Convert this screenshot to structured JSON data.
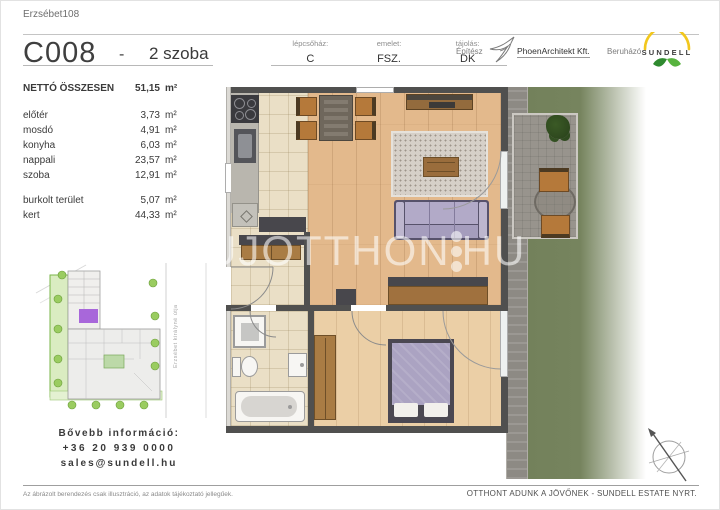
{
  "header": {
    "project": "Erzsébet108",
    "unit_code": "C008",
    "separator": "-",
    "rooms": "2 szoba",
    "columns": [
      {
        "label": "lépcsőház:",
        "value": "C"
      },
      {
        "label": "emelet:",
        "value": "FSZ."
      },
      {
        "label": "tájolás:",
        "value": "DK"
      }
    ],
    "architect_label": "Építész",
    "architect_name": "PhoenArchitekt Kft.",
    "developer_label": "Beruházó",
    "developer_name": "SUNDELL"
  },
  "area_table": {
    "total_label": "NETTÓ ÖSSZESEN",
    "total_value": "51,15",
    "unit": "m²",
    "rooms": [
      {
        "name": "előtér",
        "value": "3,73"
      },
      {
        "name": "mosdó",
        "value": "4,91"
      },
      {
        "name": "konyha",
        "value": "6,03"
      },
      {
        "name": "nappali",
        "value": "23,57"
      },
      {
        "name": "szoba",
        "value": "12,91"
      }
    ],
    "extras": [
      {
        "name": "burkolt terület",
        "value": "5,07"
      },
      {
        "name": "kert",
        "value": "44,33"
      }
    ]
  },
  "site_plan": {
    "street_name": "Erzsébet királyné útja"
  },
  "contact": {
    "heading": "Bővebb információ:",
    "phone": "+36 20 939 0000",
    "email": "sales@sundell.hu"
  },
  "watermark": {
    "left": "UJOTTHON",
    "right": "HU"
  },
  "footer": {
    "disclaimer": "Az ábrázolt berendezés csak illusztráció, az adatok tájékoztató jellegűek.",
    "slogan": "OTTHONT ADUNK A JÖVŐNEK - SUNDELL ESTATE NYRT."
  },
  "colors": {
    "accent_purple": "#9b4fd6",
    "sofa_lavender": "#b0a8c6",
    "sundell_yellow": "#f2c71d",
    "sundell_green": "#3f9b3f",
    "grass_green": "#72805a",
    "wood_floor": "#e3b98c"
  }
}
